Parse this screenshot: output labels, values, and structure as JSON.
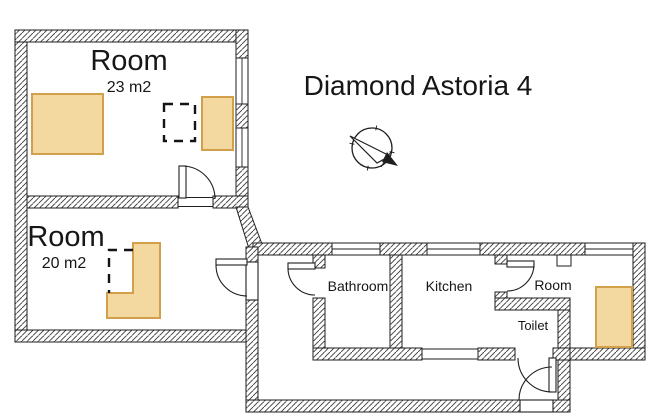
{
  "title": "Diamond Astoria 4",
  "rooms": {
    "room_23": {
      "label": "Room",
      "area": "23 m2"
    },
    "room_20": {
      "label": "Room",
      "area": "20 m2"
    },
    "bathroom": {
      "label": "Bathroom"
    },
    "kitchen": {
      "label": "Kitchen"
    },
    "room_small": {
      "label": "Room"
    },
    "toilet": {
      "label": "Toilet"
    }
  },
  "colors": {
    "furniture_fill": "#F3D9A0",
    "furniture_stroke": "#D2A04A",
    "wall_line": "#1E1E1E",
    "text": "#161616"
  }
}
